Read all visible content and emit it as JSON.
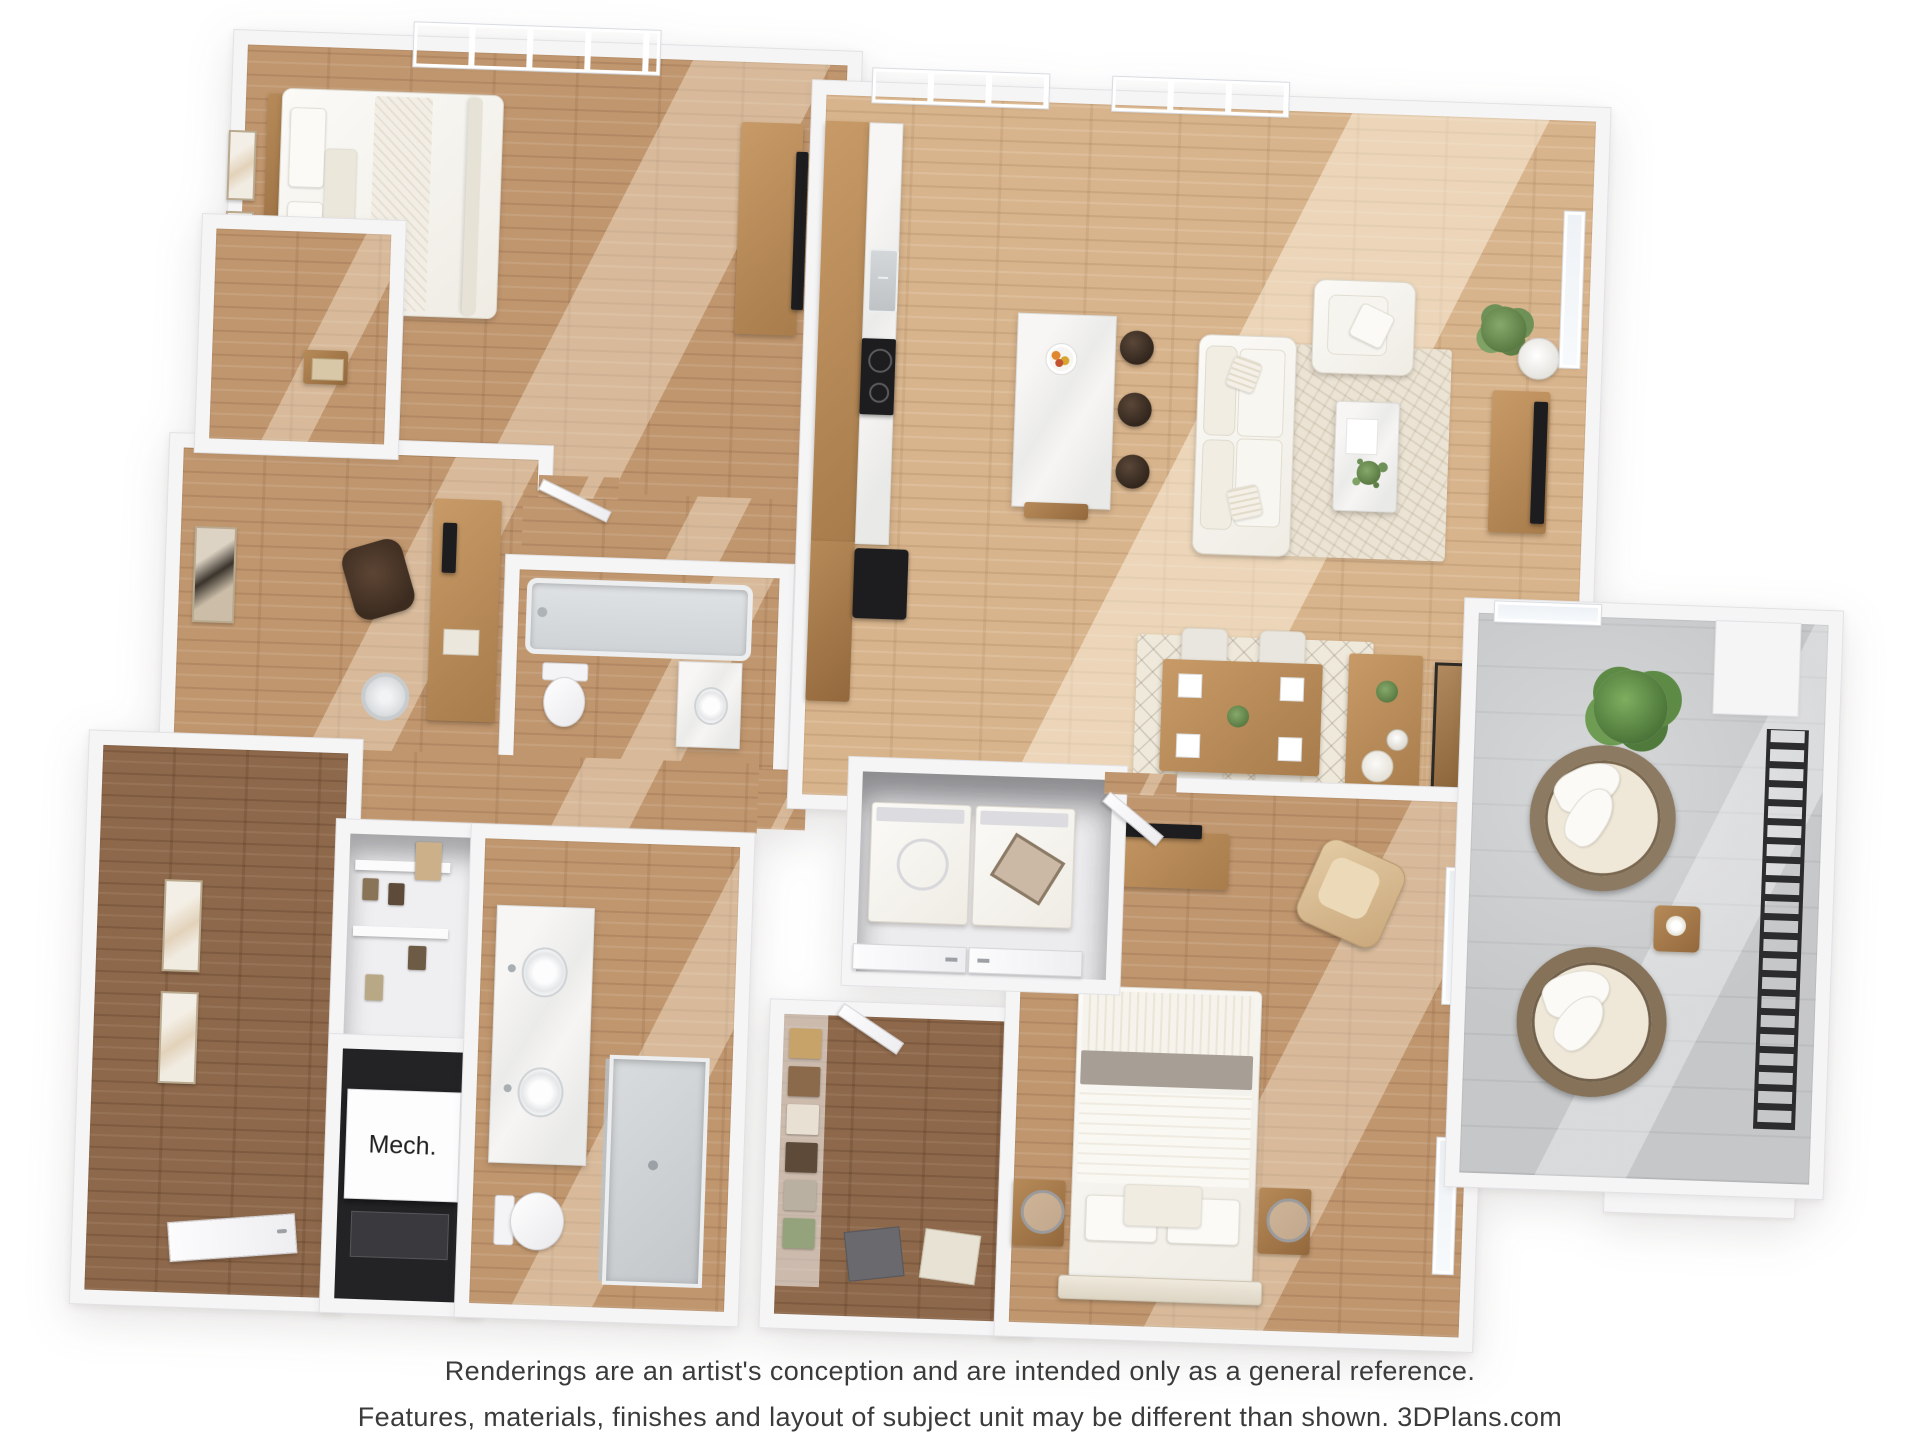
{
  "labels": {
    "mech_room": "Mech."
  },
  "disclaimer": {
    "line1": "Renderings are an artist's conception and are intended only as a general reference.",
    "line2": "Features, materials, finishes and layout of subject unit may be different than shown. 3DPlans.com"
  },
  "palette": {
    "background": "#ffffff",
    "wall_fill": "#f5f5f6",
    "wall_edge": "#e2e2e5",
    "floor_wood_light": "#d8b48c",
    "floor_wood_mid": "#c0966e",
    "floor_wood_dark": "#8e684a",
    "balcony_concrete": "#c5c7c9",
    "railing_black": "#2c2c2e",
    "appliance_black": "#1d1d1f",
    "cabinet_wood": "#b98a58",
    "upholstery_cream": "#f3f0e9",
    "rug_cream": "#ebe3d4",
    "plant_green": "#6d9157",
    "text_dark": "#3b3b3b"
  }
}
